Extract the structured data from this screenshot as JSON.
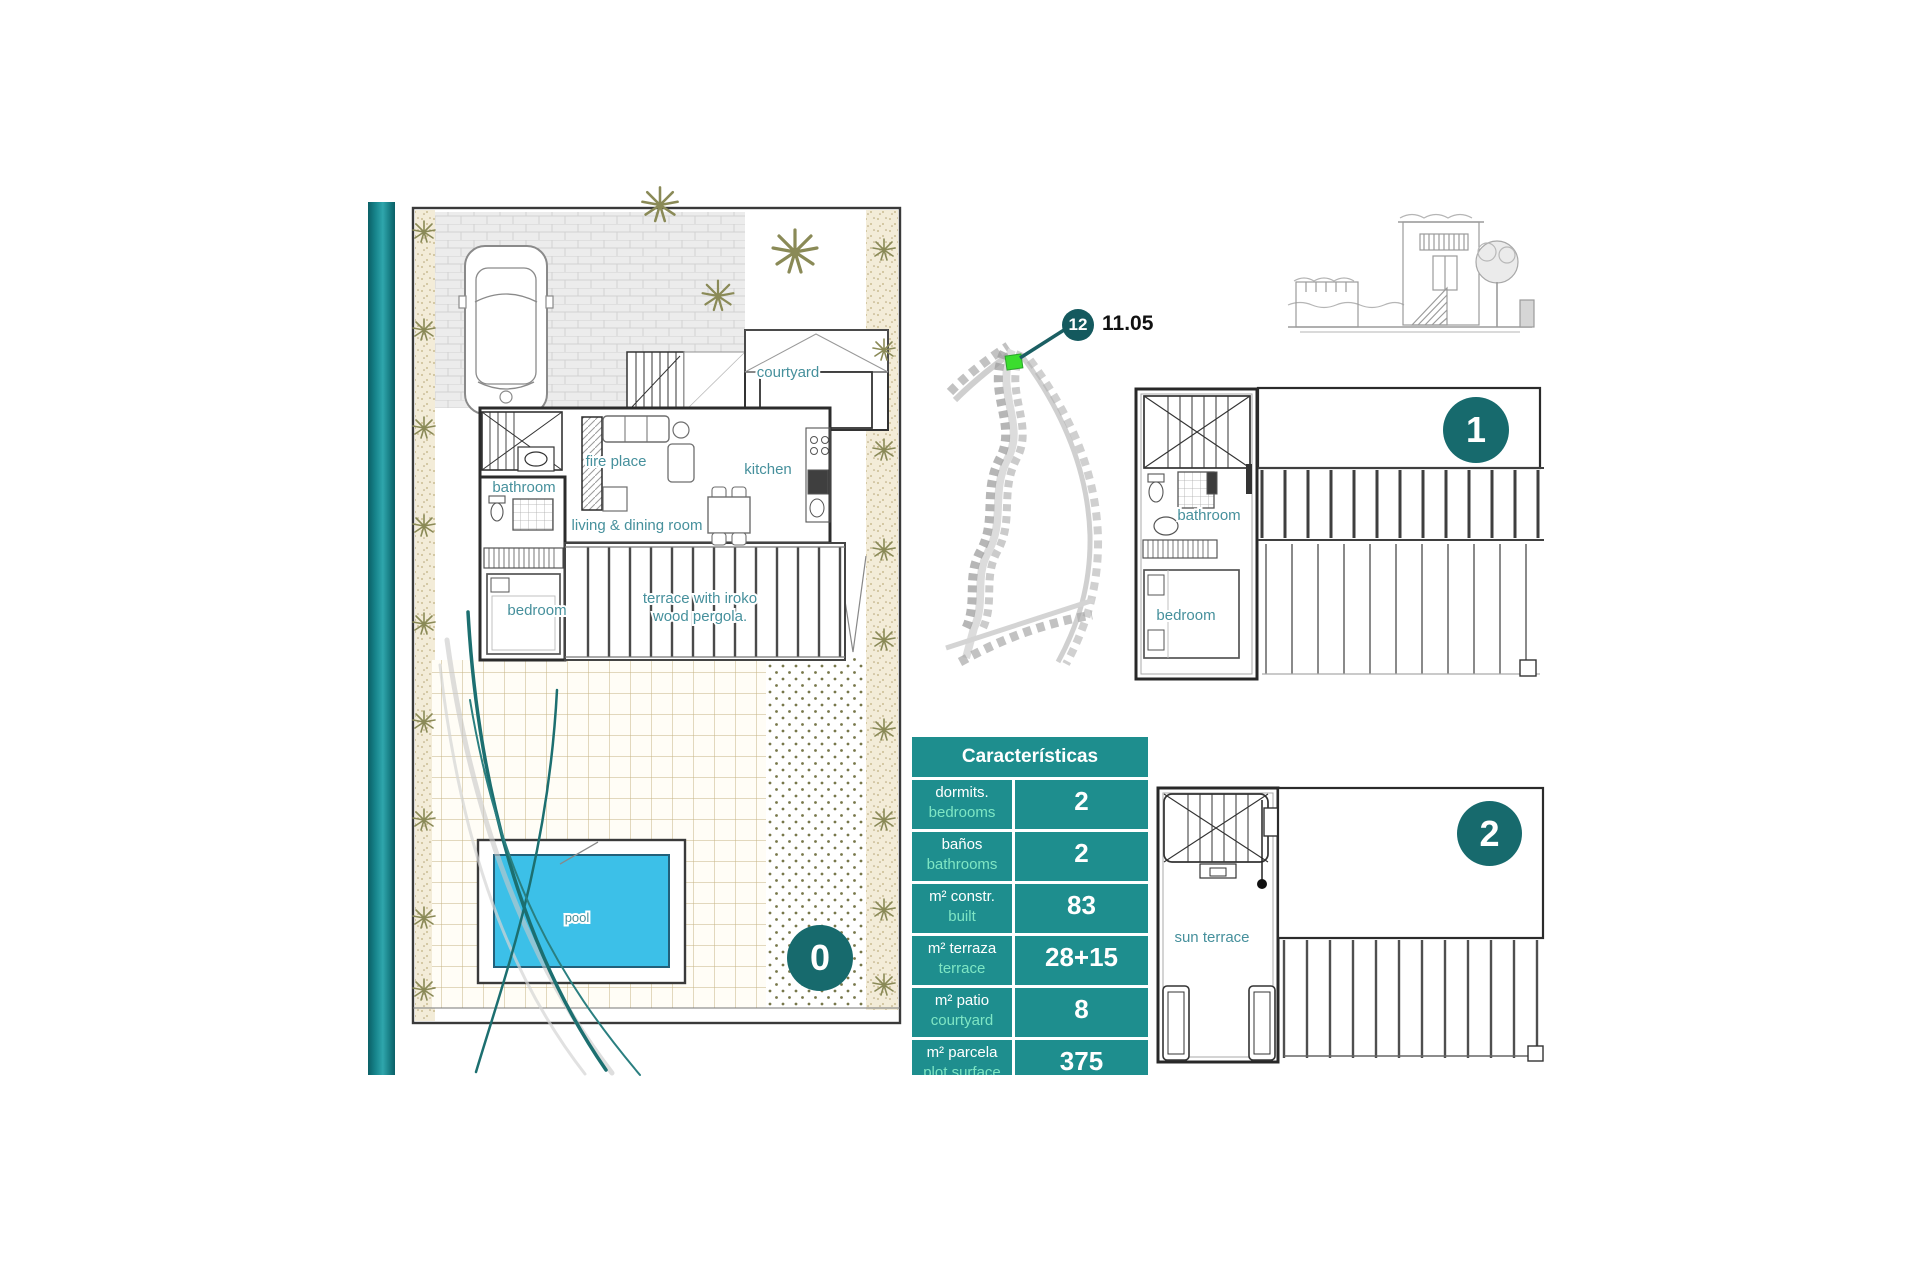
{
  "marker": {
    "number": "12",
    "value": "11.05"
  },
  "levels": {
    "ground": "0",
    "first": "1",
    "second": "2"
  },
  "plans": {
    "ground": {
      "bathroom": "bathroom",
      "fire_place": "fire place",
      "kitchen": "kitchen",
      "living_dining": "living & dining room",
      "bedroom": "bedroom",
      "terrace_line1": "terrace with iroko",
      "terrace_line2": "wood pergola.",
      "courtyard": "courtyard",
      "pool": "pool"
    },
    "first": {
      "bathroom": "bathroom",
      "bedroom": "bedroom"
    },
    "second": {
      "sun_terrace": "sun terrace"
    }
  },
  "table": {
    "title": "Características",
    "rows": [
      {
        "es": "dormits.",
        "en": "bedrooms",
        "value": "2"
      },
      {
        "es": "baños",
        "en": "bathrooms",
        "value": "2"
      },
      {
        "es": "m² constr.",
        "en": "built",
        "value": "83"
      },
      {
        "es": "m² terraza",
        "en": "terrace",
        "value": "28+15"
      },
      {
        "es": "m² patio",
        "en": "courtyard",
        "value": "8"
      },
      {
        "es": "m² parcela",
        "en": "plot surface",
        "value": "375"
      }
    ]
  },
  "colors": {
    "table_teal": "#1e8e8e",
    "table_sub_label": "#7fe6c4",
    "badge_teal": "#176a6d",
    "marker_badge_teal": "#14595e",
    "plot_highlight_green": "#3bdd2e",
    "pool_water": "#3cc0e8",
    "room_label": "#46909c",
    "accent_bar_dark": "#0b5f66",
    "accent_bar_light": "#2fa6ac"
  }
}
